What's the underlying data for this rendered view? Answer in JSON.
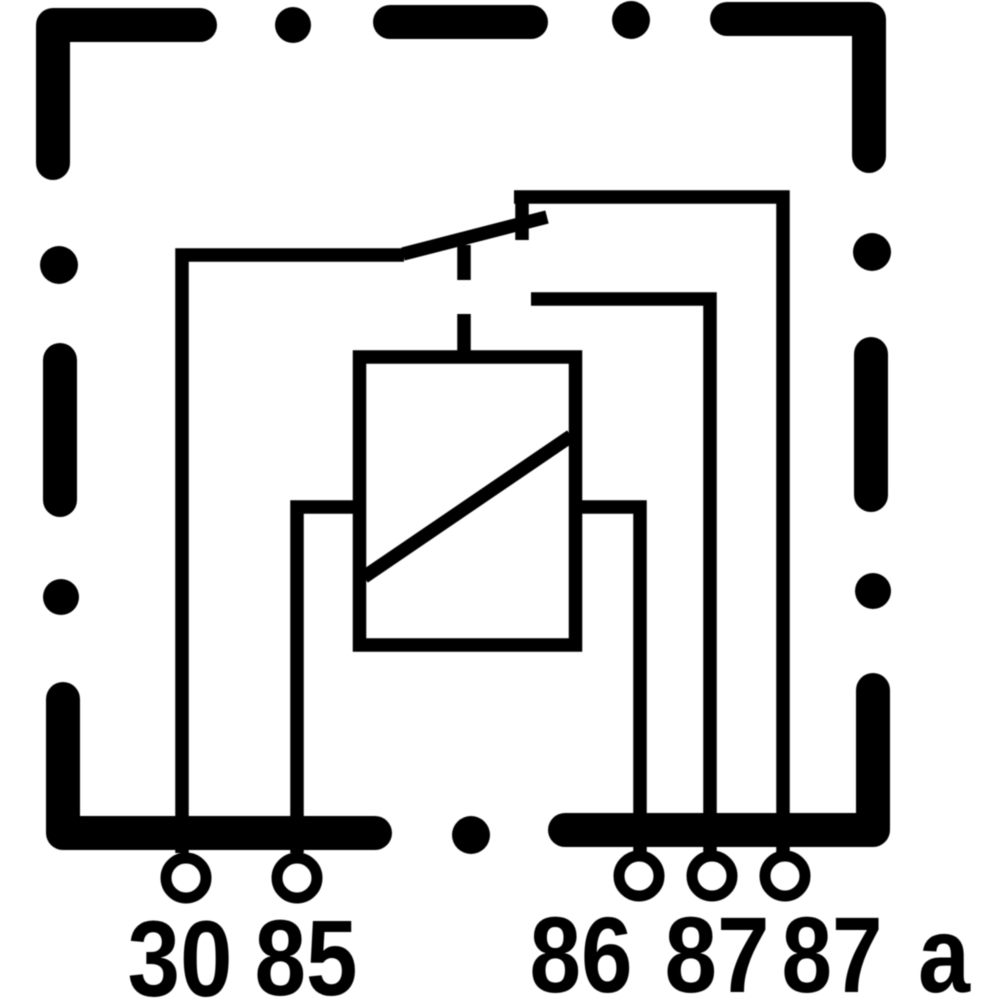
{
  "canvas": {
    "background": "#ffffff",
    "ink": "#000000"
  },
  "diagram": {
    "kind": "relay-internal-wiring-schematic",
    "components": {
      "housing": "dashed-outline",
      "coil": "rectangle-with-diagonal",
      "switch": "changeover-arm-from-30-resting-on-87a"
    },
    "terminal_labels": [
      "30",
      "85",
      "86",
      "87",
      "87",
      "a"
    ]
  }
}
